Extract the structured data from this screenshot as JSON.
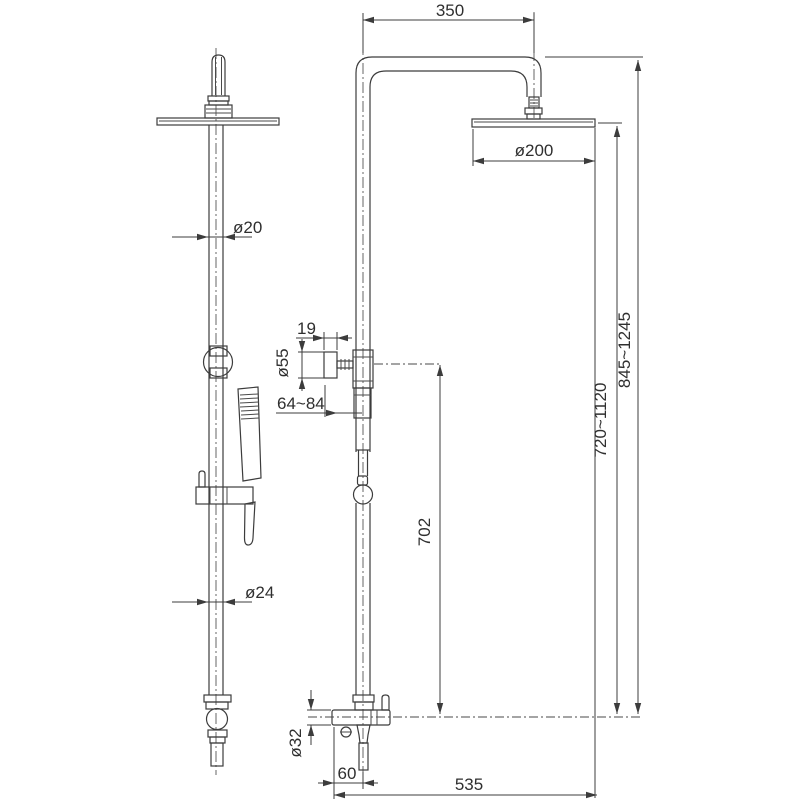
{
  "drawing": {
    "type": "technical-dimension-drawing",
    "subject": "shower-column-system-two-views",
    "background": "#ffffff",
    "line_color": "#3c3c3c",
    "dimensions": {
      "top_width": "350",
      "head_diameter": "ø200",
      "pipe_upper_diameter": "ø20",
      "knob_depth": "19",
      "knob_diameter": "ø55",
      "wall_distance": "64~84",
      "outlet_to_valve_height": "702",
      "adjustable_inner_height": "720~1120",
      "adjustable_total_height": "845~1245",
      "pipe_lower_diameter": "ø24",
      "bar_diameter": "ø32",
      "outlet_offset": "60",
      "total_reach": "535"
    }
  }
}
